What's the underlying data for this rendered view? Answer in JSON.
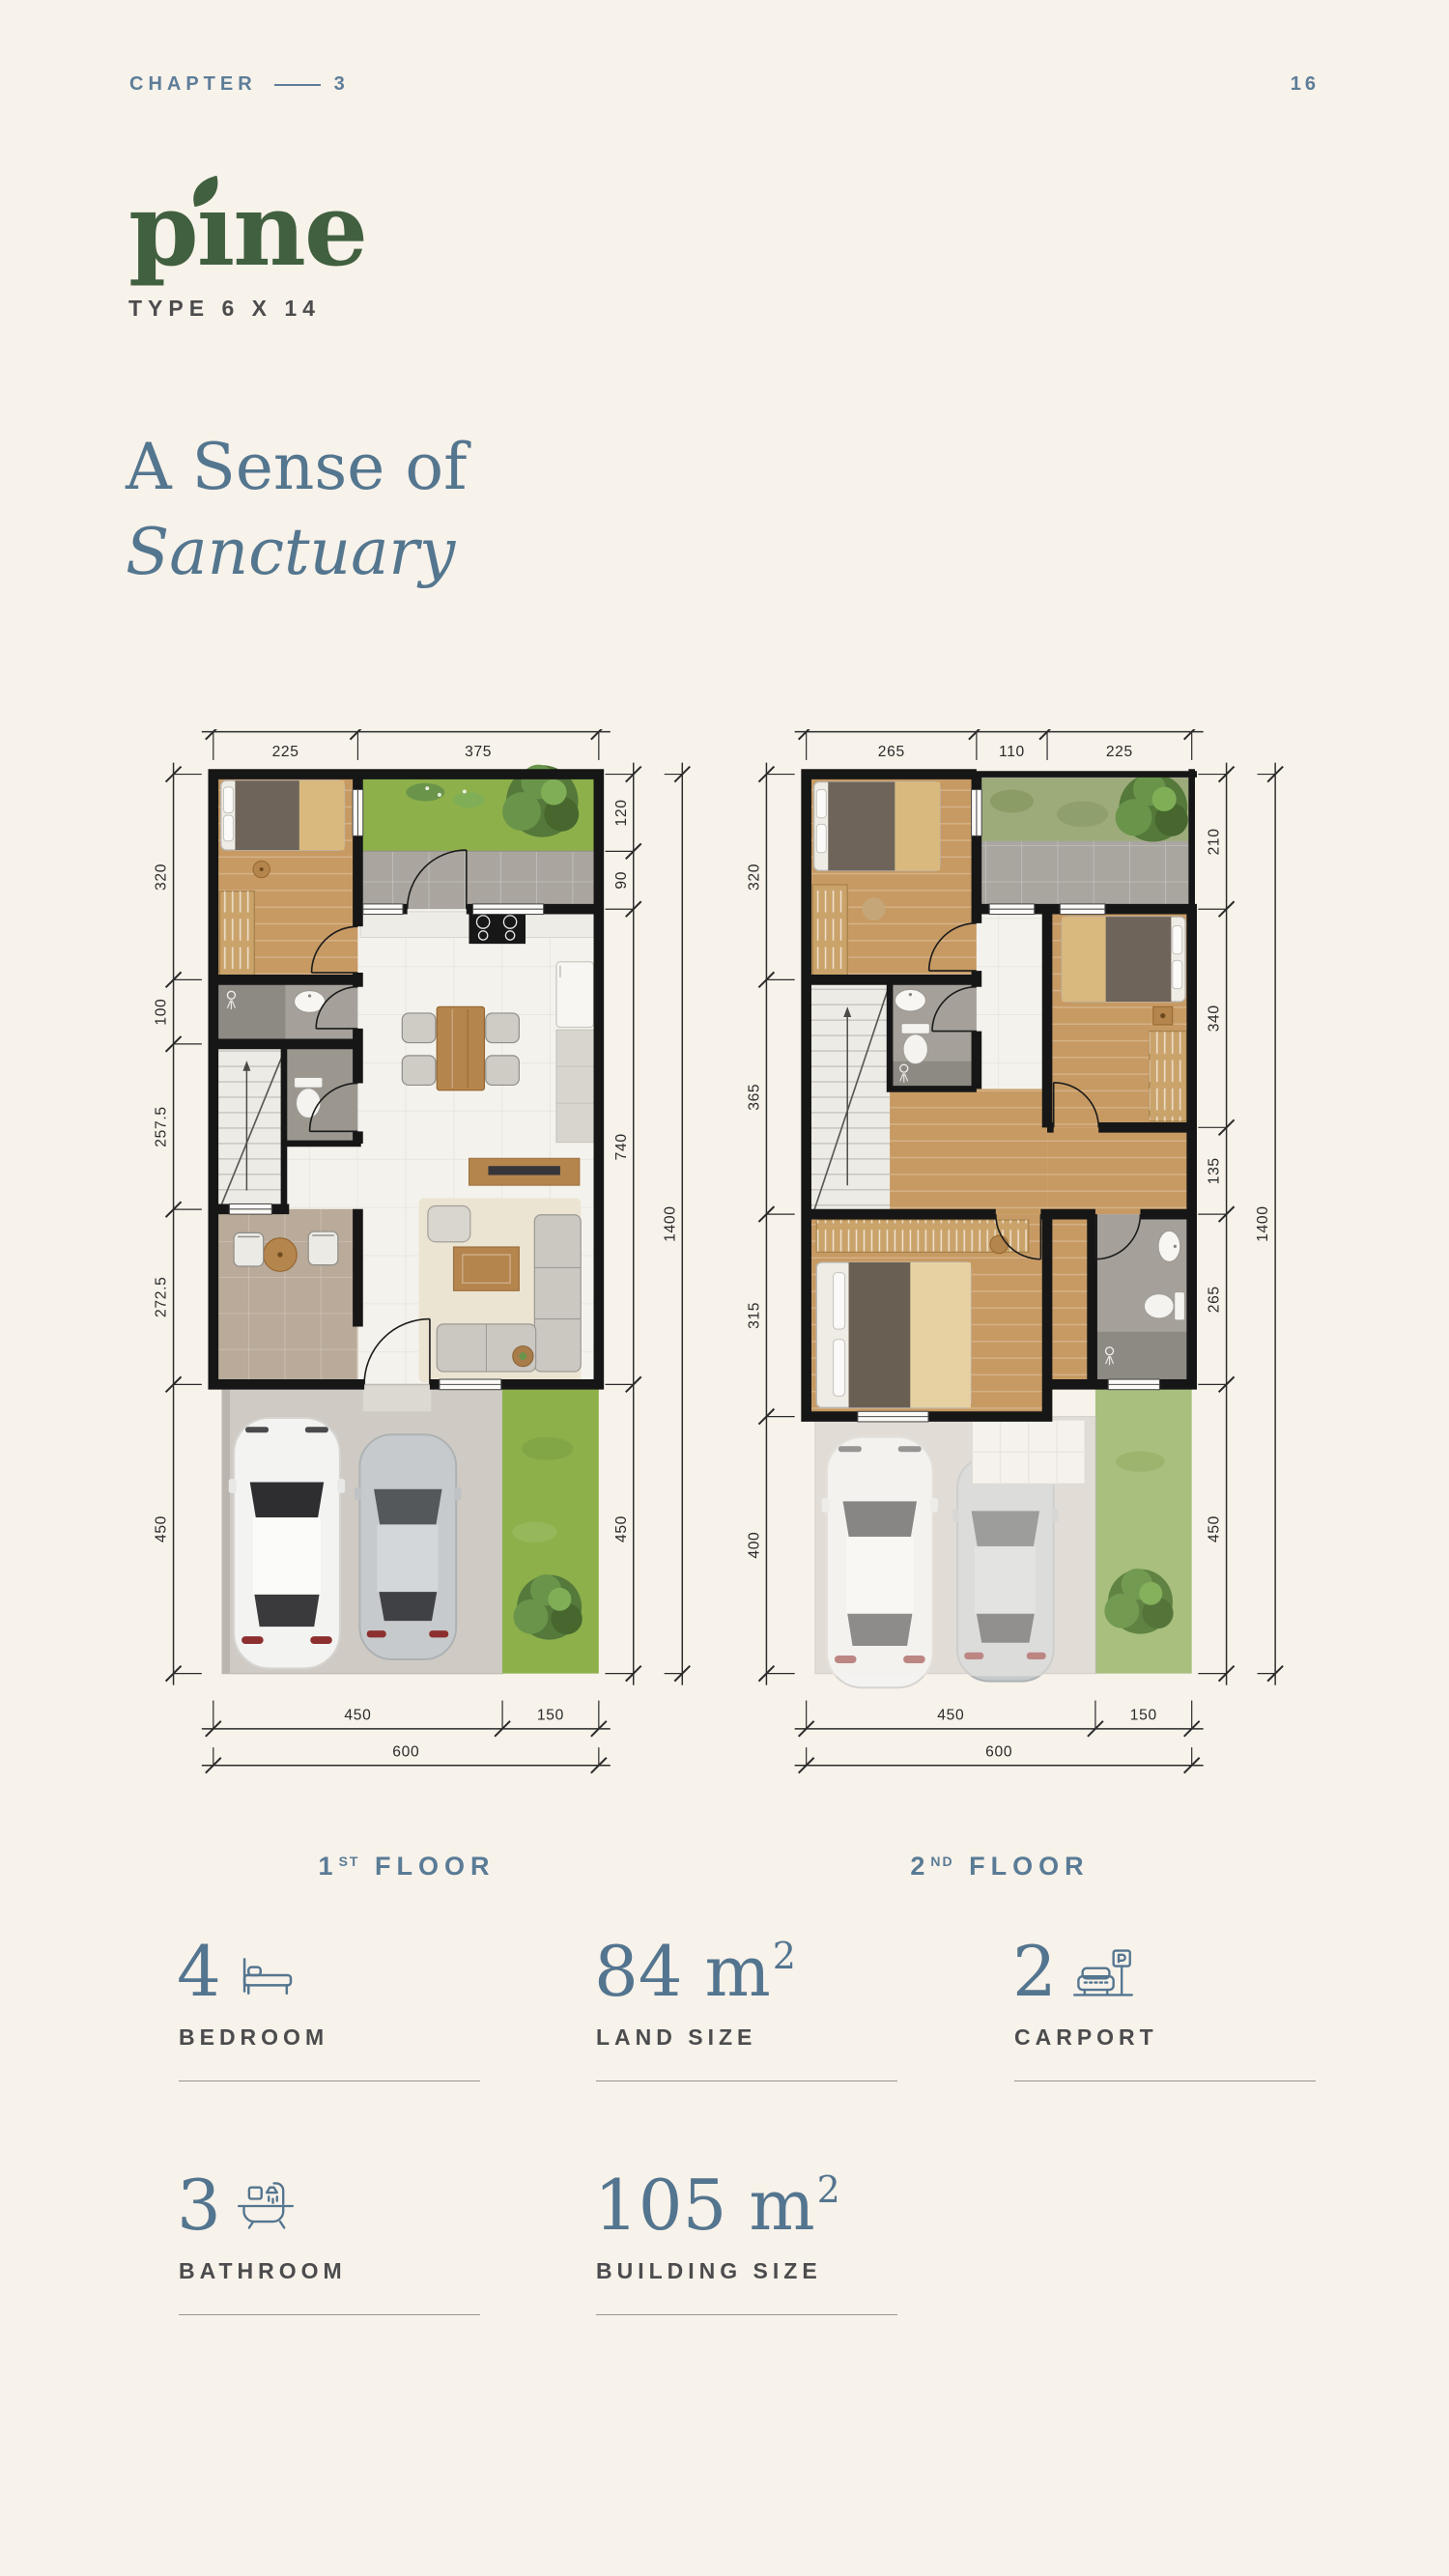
{
  "header": {
    "chapter_label": "CHAPTER",
    "chapter_number": "3",
    "page_number": "16"
  },
  "brand": {
    "name_part1": "p",
    "name_part2": "ı",
    "name_part3": "ne",
    "type_label": "TYPE 6 X 14"
  },
  "title": {
    "line1": "A Sense of",
    "line2": "Sanctuary"
  },
  "plans": {
    "first": {
      "dims_top": [
        "225",
        "375"
      ],
      "dims_left": [
        "320",
        "100",
        "257.5",
        "272.5",
        "450"
      ],
      "dims_right_inner": [
        "120",
        "90",
        "740",
        "450"
      ],
      "dims_right_outer": [
        "1400"
      ],
      "dims_bottom": [
        "450",
        "150"
      ],
      "dims_bottom_total": [
        "600"
      ]
    },
    "second": {
      "dims_top": [
        "265",
        "110",
        "225"
      ],
      "dims_left": [
        "320",
        "365",
        "315",
        "400"
      ],
      "dims_right_inner": [
        "210",
        "340",
        "135",
        "265",
        "450"
      ],
      "dims_right_outer": [
        "1400"
      ],
      "dims_bottom": [
        "450",
        "150"
      ],
      "dims_bottom_total": [
        "600"
      ]
    }
  },
  "floor_labels": {
    "first": {
      "num": "1",
      "sup": "ST",
      "word": "FLOOR"
    },
    "second": {
      "num": "2",
      "sup": "ND",
      "word": "FLOOR"
    }
  },
  "stats": {
    "bedroom": {
      "value": "4",
      "sup": "",
      "label": "BEDROOM"
    },
    "land": {
      "value": "84 m",
      "sup": "2",
      "label": "LAND SIZE"
    },
    "carport": {
      "value": "2",
      "sup": "",
      "label": "CARPORT"
    },
    "bathroom": {
      "value": "3",
      "sup": "",
      "label": "BATHROOM"
    },
    "building": {
      "value": "105 m",
      "sup": "2",
      "label": "BUILDING SIZE"
    }
  },
  "colors": {
    "accent_blue": "#54758f",
    "accent_green": "#41603f",
    "text_dark": "#4c4c4e",
    "background": "#f7f2ea"
  }
}
